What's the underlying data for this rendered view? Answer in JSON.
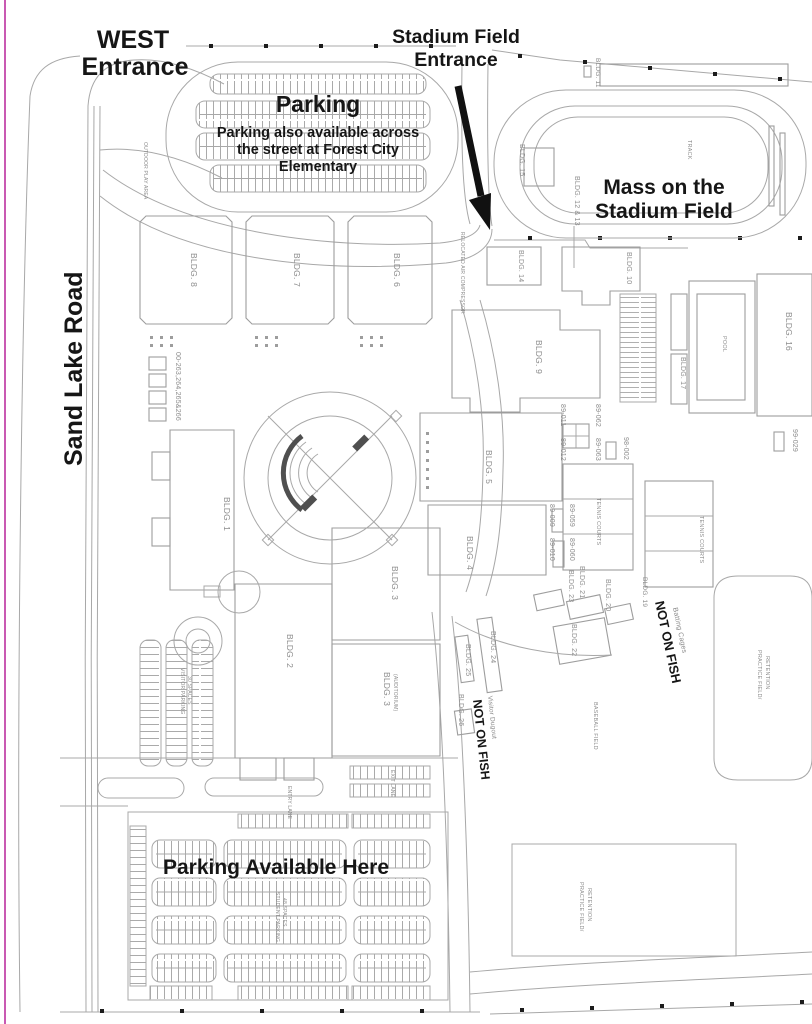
{
  "entrances": {
    "west_line1": "WEST",
    "west_line2": "Entrance",
    "stadium_line1": "Stadium Field",
    "stadium_line2": "Entrance"
  },
  "roads": {
    "sand_lake_road": "Sand Lake Road"
  },
  "event": {
    "mass_line1": "Mass on the",
    "mass_line2": "Stadium Field"
  },
  "parking": {
    "north_title": "Parking",
    "north_note1": "Parking also available across",
    "north_note2": "the street at Forest City",
    "north_note3": "Elementary",
    "south_label": "Parking Available Here",
    "visitor_line1": "VISITOR PARKING",
    "visitor_line2": "30 SPACES",
    "student_line1": "STUDENT PARKING",
    "student_line2": "48 SPACES",
    "entry_lane": "ENTRY LANE",
    "exit_lane": "EXIT LANE"
  },
  "buildings": {
    "b1": "BLDG. 1",
    "b2": "BLDG. 2",
    "b3": "BLDG. 3",
    "b3aud": "BLDG. 3",
    "b3aud_sub": "(AUDITORIUM)",
    "b4": "BLDG. 4",
    "b5": "BLDG. 5",
    "b6": "BLDG. 6",
    "b7": "BLDG. 7",
    "b8": "BLDG. 8",
    "b9": "BLDG. 9",
    "b10": "BLDG. 10",
    "b11": "BLDG. 11",
    "b12_13": "BLDG. 12 & 13",
    "b14": "BLDG. 14",
    "b15": "BLDG. 15",
    "b16": "BLDG. 16",
    "b17": "BLDG. 17",
    "b19": "BLDG. 19",
    "b20": "BLDG. 20",
    "b21": "BLDG. 21",
    "b22": "BLDG. 22",
    "b23": "BLDG. 23",
    "b24": "BLDG. 24",
    "b25": "BLDG. 25",
    "b26": "BLDG. 26",
    "portables": "00-263,264,265&266"
  },
  "facilities": {
    "track": "TRACK",
    "pool": "POOL",
    "tennis": "TENNIS COURTS",
    "baseball": "BASEBALL FIELD",
    "practice_line1": "PRACTICE FIELD/",
    "practice_line2": "RETENTION",
    "batting_cages": "Batting Cages",
    "visitor_dugout": "Visitor Dugout",
    "outdoor_play": "OUTDOOR PLAY AREA",
    "relocated": "RELOCATED AIR COMPRESSOR"
  },
  "codes": {
    "c89_011": "89-011",
    "c89_062": "89-062",
    "c89_012": "89-012",
    "c89_063": "89-063",
    "c98_002": "98-002",
    "c99_029": "99-029",
    "c89_009": "89-009",
    "c89_059": "89-059",
    "c89_010": "89-010",
    "c89_060": "89-060"
  },
  "notices": {
    "not_on_fish": "NOT ON FISH"
  },
  "colors": {
    "line": "#a8a8a8",
    "annotation": "#161616",
    "map_text": "#8c8c8c",
    "edge_pink": "#c959b2"
  }
}
